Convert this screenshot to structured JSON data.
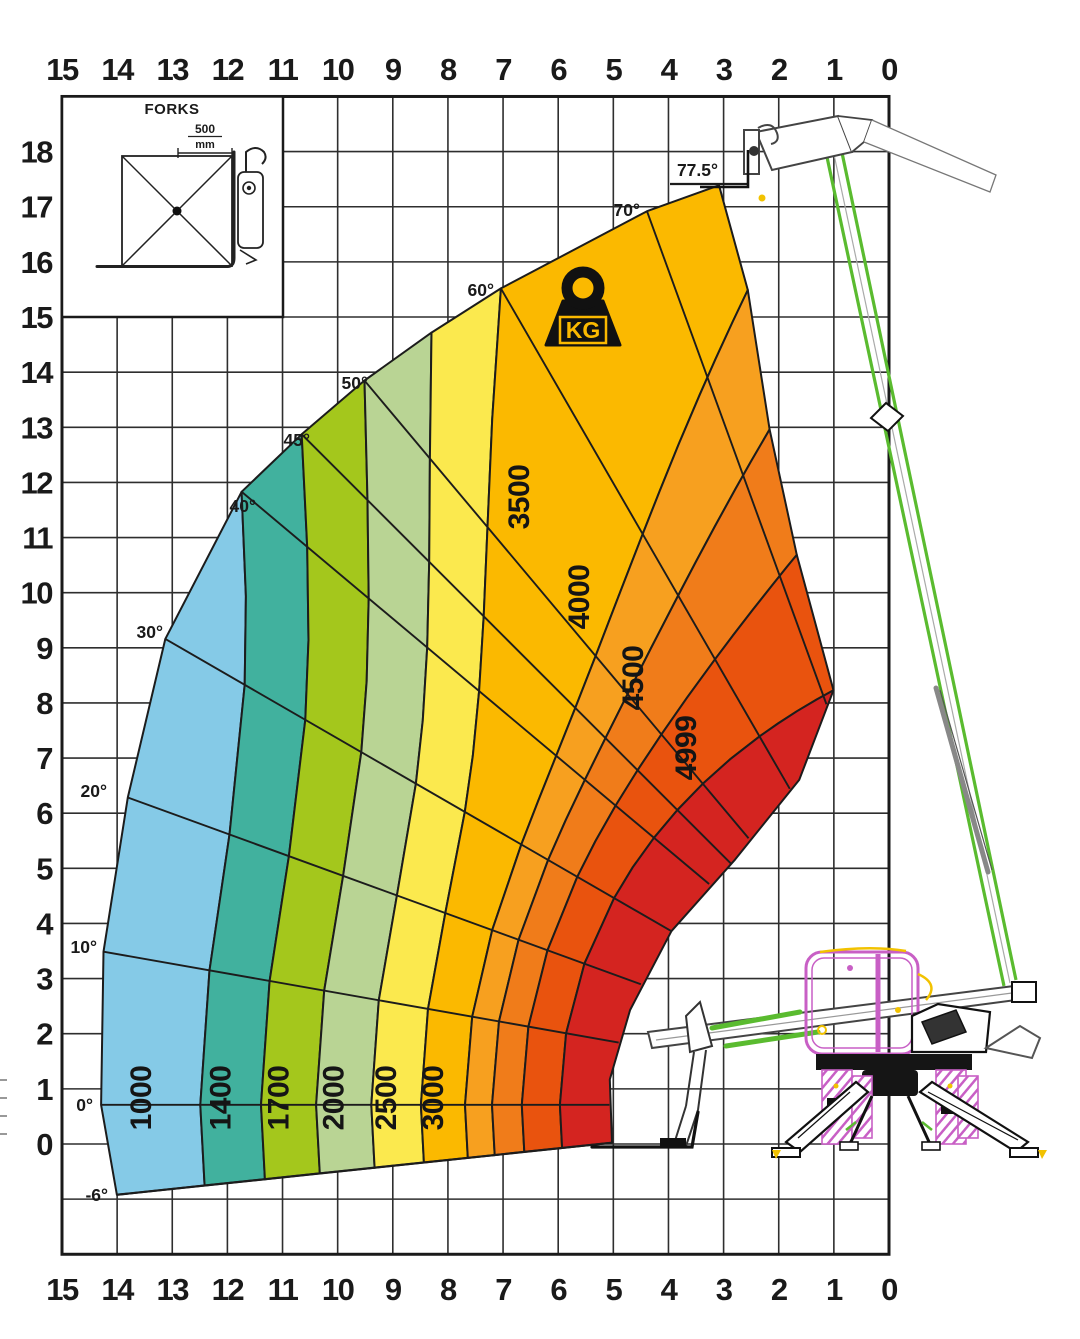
{
  "chart_data": {
    "type": "load-capacity-diagram",
    "title": "Telehandler load capacity chart (kg) by reach and height",
    "x_ticks": [
      "15",
      "14",
      "13",
      "12",
      "11",
      "10",
      "9",
      "8",
      "7",
      "6",
      "5",
      "4",
      "3",
      "2",
      "1",
      "0"
    ],
    "y_ticks": [
      "18",
      "17",
      "16",
      "15",
      "14",
      "13",
      "12",
      "11",
      "10",
      "9",
      "8",
      "7",
      "6",
      "5",
      "4",
      "3",
      "2",
      "1",
      "0"
    ],
    "grid": true,
    "legend_position": "none",
    "angle_lines": [
      {
        "deg": -6,
        "label": "-6°"
      },
      {
        "deg": 0,
        "label": "0°"
      },
      {
        "deg": 10,
        "label": "10°"
      },
      {
        "deg": 20,
        "label": "20°"
      },
      {
        "deg": 30,
        "label": "30°"
      },
      {
        "deg": 40,
        "label": "40°"
      },
      {
        "deg": 45,
        "label": "45°"
      },
      {
        "deg": 50,
        "label": "50°"
      },
      {
        "deg": 60,
        "label": "60°"
      },
      {
        "deg": 70,
        "label": "70°"
      },
      {
        "deg": 77.5,
        "label": "77.5°"
      }
    ],
    "capacity_bands": [
      {
        "load_kg": "1000",
        "color": "#85CAE7"
      },
      {
        "load_kg": "1400",
        "color": "#41B19E"
      },
      {
        "load_kg": "1700",
        "color": "#A4C71C"
      },
      {
        "load_kg": "2000",
        "color": "#B9D494"
      },
      {
        "load_kg": "2500",
        "color": "#FBE94E"
      },
      {
        "load_kg": "3000",
        "color": "#FBB900"
      },
      {
        "load_kg": "3500",
        "color": "#F7A01F"
      },
      {
        "load_kg": "4000",
        "color": "#F07C1A"
      },
      {
        "load_kg": "4500",
        "color": "#E9530E"
      },
      {
        "load_kg": "4999",
        "color": "#D42420"
      }
    ],
    "geometry": {
      "pivot_m": {
        "x": -1.51,
        "y": 0.71
      },
      "outer_envelope_deg_m": [
        [
          -6,
          15.6
        ],
        [
          0,
          15.8
        ],
        [
          10,
          16.0
        ],
        [
          20,
          16.3
        ],
        [
          30,
          16.9
        ],
        [
          40,
          17.3
        ],
        [
          45,
          17.2
        ],
        [
          50,
          17.15
        ],
        [
          55,
          17.1
        ],
        [
          60,
          17.1
        ],
        [
          70,
          17.25
        ],
        [
          74.6,
          17.3
        ]
      ],
      "band_boundaries": [
        {
          "r_bottom": 14.0,
          "r_top": 17.3,
          "top_deg": 40
        },
        {
          "r_bottom": 12.9,
          "r_top": 17.2,
          "top_deg": 45
        },
        {
          "r_bottom": 11.9,
          "r_top": 17.15,
          "top_deg": 50
        },
        {
          "r_bottom": 10.9,
          "r_top": 17.1,
          "top_deg": 55
        },
        {
          "r_bottom": 10.0,
          "r_top": 17.1,
          "top_deg": 60
        },
        {
          "r_bottom": 9.2,
          "r_top": 15.33,
          "top_deg": 74.6
        },
        {
          "r_bottom": 8.71,
          "r_top": 12.79,
          "top_deg": 73.3
        },
        {
          "r_bottom": 8.17,
          "r_top": 10.47,
          "top_deg": 72.3
        },
        {
          "r_bottom": 7.48,
          "r_top": 7.93,
          "top_deg": 71.5
        }
      ],
      "right_edge_deg_m": [
        [
          74.6,
          17.3
        ],
        [
          74.6,
          15.33
        ],
        [
          73.3,
          12.79
        ],
        [
          72.3,
          10.47
        ],
        [
          71.5,
          7.93
        ]
      ],
      "inner_edge_deg_m": [
        [
          71.5,
          7.93
        ],
        [
          62,
          6.68
        ],
        [
          46,
          6.19
        ],
        [
          30,
          6.3
        ],
        [
          15.5,
          6.44
        ],
        [
          4,
          6.59
        ],
        [
          -6,
          6.57
        ]
      ],
      "drawn_angle_lines_deg": [
        0,
        10,
        20,
        30,
        40,
        45,
        50,
        60,
        70
      ]
    }
  },
  "inset": {
    "title": "FORKS",
    "dim_value": "500",
    "dim_unit": "mm"
  },
  "kg_icon": {
    "label": "KG"
  },
  "colors": {
    "grid": "#2e2e2e",
    "border": "#1a1a1a",
    "text": "#1a1a1a",
    "fan_stroke": "#1c1c1c",
    "machine_green": "#5ABB2F",
    "machine_magenta": "#C85FC5",
    "machine_yellow": "#F2C200",
    "machine_gray": "#555555"
  }
}
